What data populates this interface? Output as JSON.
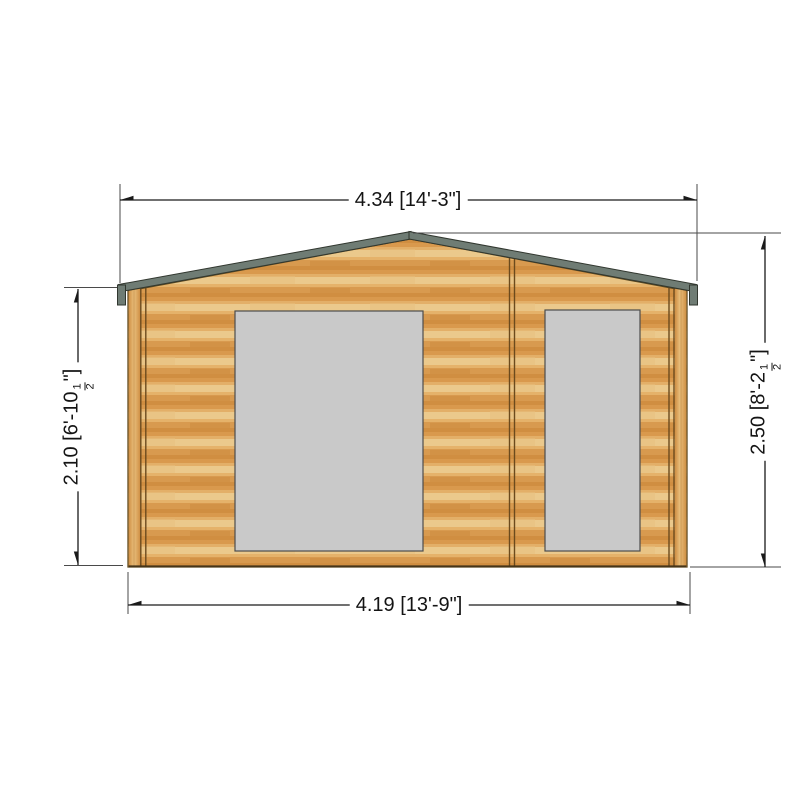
{
  "drawing": {
    "type": "log-cabin-front-elevation",
    "dimensions": {
      "overall_width": {
        "pre": "4.34 [14'-3\"]",
        "frac_num": "",
        "frac_den": "",
        "post": ""
      },
      "base_width": {
        "pre": "4.19 [13'-9\"]",
        "frac_num": "",
        "frac_den": "",
        "post": ""
      },
      "wall_height": {
        "pre": "2.10 [6'-10",
        "frac_num": "1",
        "frac_den": "2",
        "post": "\"]"
      },
      "ridge_height": {
        "pre": "2.50 [8'-2",
        "frac_num": "1",
        "frac_den": "2",
        "post": "\"]"
      }
    },
    "colors": {
      "wood_light": "#ebc98c",
      "wood_orange": "#d89a4f",
      "trim_dark": "#6b4a1d",
      "roof_gray": "#6f7c74",
      "window_gray": "#c9c9c9",
      "line_color": "#1a1a1a",
      "background": "#ffffff"
    }
  }
}
